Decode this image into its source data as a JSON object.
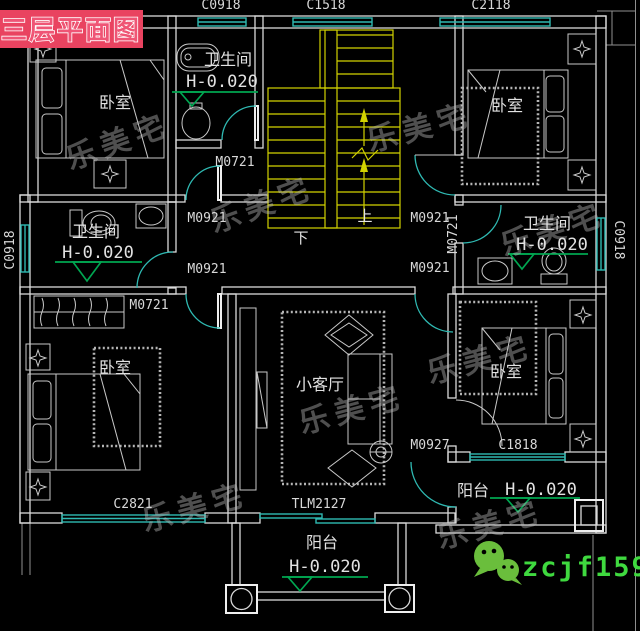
{
  "title": {
    "label": "三层平面图"
  },
  "dimensions": {
    "top": [
      "C0918",
      "C1518",
      "C2118"
    ],
    "left": "C0918",
    "right": "C0918"
  },
  "rooms": {
    "bedroom_top_left": {
      "label": "卧室"
    },
    "bedroom_top_right": {
      "label": "卧室"
    },
    "bedroom_bottom_left": {
      "label": "卧室"
    },
    "bedroom_bottom_right": {
      "label": "卧室"
    },
    "bathroom_top": {
      "label": "卫生间",
      "elevation": "H-0.020"
    },
    "bathroom_left": {
      "label": "卫生间",
      "elevation": "H-0.020"
    },
    "bathroom_right": {
      "label": "卫生间",
      "elevation": "H-0.020"
    },
    "living_room": {
      "label": "小客厅"
    },
    "balcony_bottom": {
      "label": "阳台",
      "elevation": "H-0.020"
    },
    "balcony_right": {
      "label": "阳台",
      "elevation": "H-0.020"
    }
  },
  "stairs": {
    "up": "上",
    "down": "下"
  },
  "openings": {
    "door_top_bath": "M0721",
    "door_hall_upper_left": "M0921",
    "door_hall_lower_left": "M0921",
    "door_bedroom_bottom_left": "M0721",
    "door_hall_upper_right": "M0921",
    "door_bath_right": "M0721",
    "door_hall_lower_right": "M0921",
    "door_bedroom_bottom_right": "M0927",
    "window_bottom_left": "C2821",
    "window_bottom_right": "C1818",
    "sliding_door_balcony": "TLM2127"
  },
  "branding": {
    "watermark": "乐美宅",
    "wechat_id": "zcjf159"
  },
  "colors": {
    "background": "#000000",
    "wall": "#d9d9d9",
    "window_teal": "#2fb9b2",
    "stair_yellow": "#d2d200",
    "elevation_green": "#00a651",
    "title_background": "#e94360",
    "watermark_gray": "#bdbdbd",
    "wechat_green": "#6abe3c",
    "wechat_text_green": "#3fd93f"
  }
}
